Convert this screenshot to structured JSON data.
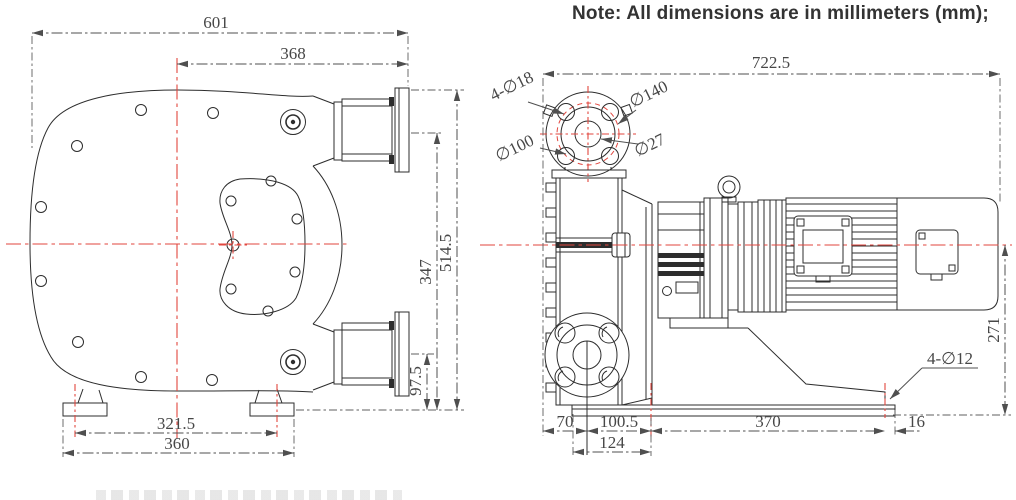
{
  "note": "Note: All dimensions are in millimeters (mm);",
  "colors": {
    "line": "#2d2d2d",
    "centerline_red": "#e2463e",
    "dim_text": "#474747",
    "background": "#ffffff"
  },
  "front_view": {
    "dims": {
      "overall_width": "601",
      "center_to_flange_face": "368",
      "upper_port_height": "347",
      "overall_height": "514.5",
      "lower_port_height": "97.5",
      "foot_hole_spacing": "321.5",
      "base_width": "360"
    }
  },
  "side_view": {
    "dims": {
      "overall_length": "722.5",
      "shaft_center_height": "271",
      "base_offset_left": "70",
      "flange_to_foot": "100.5",
      "foot_hole_pitch": "370",
      "base_offset_right": "16",
      "foot_plate_width": "124"
    },
    "labels": {
      "flange_bolt_holes": "4-∅18",
      "flange_outer_dia": "∅140",
      "flange_bolt_circle_dia": "∅100",
      "flange_bore_dia": "∅27",
      "base_holes": "4-∅12"
    }
  }
}
